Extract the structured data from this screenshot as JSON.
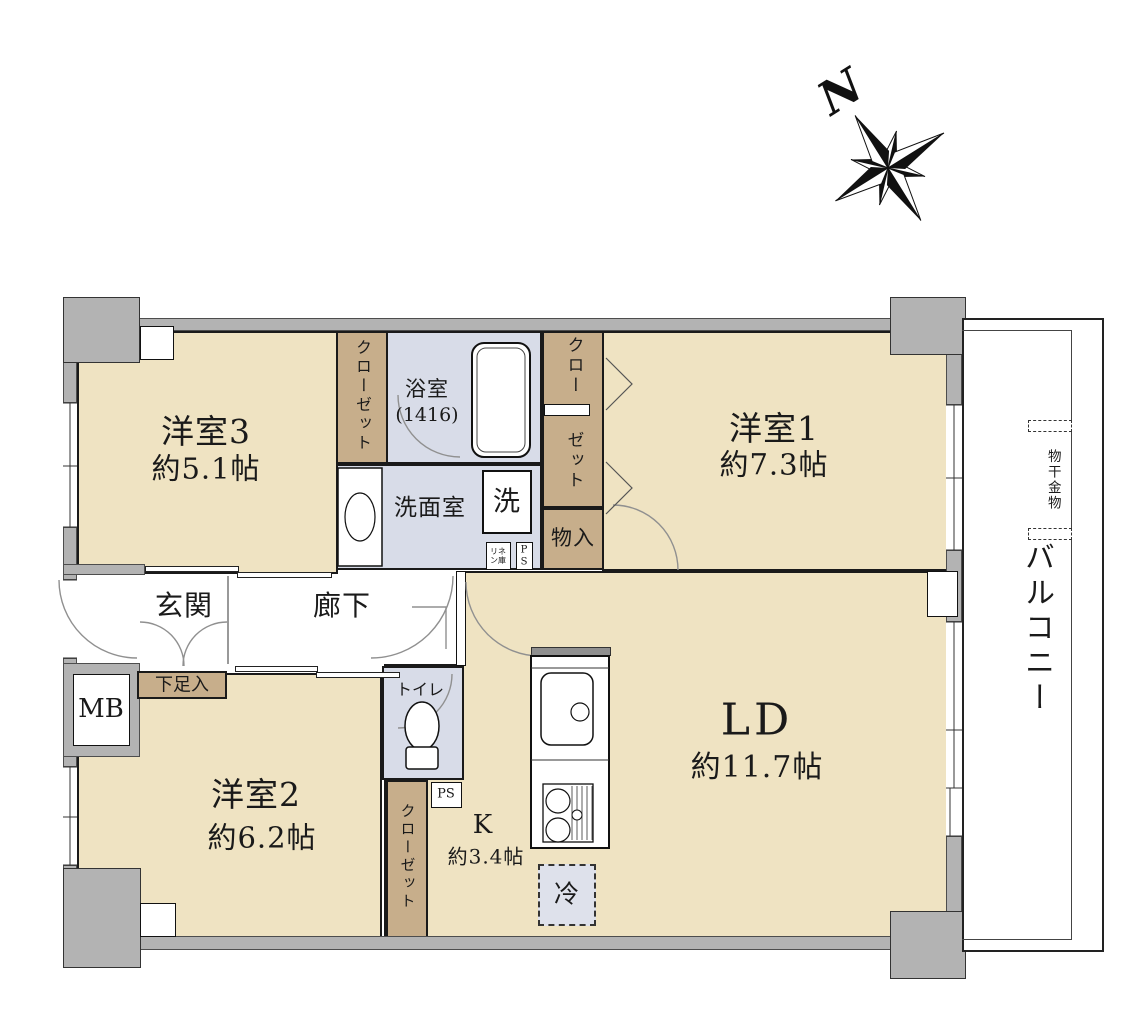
{
  "colors": {
    "room_floor": "#EFE3C2",
    "closet_tan": "#C7AE8B",
    "wet_area_blue": "#D8DCE8",
    "wall_gray": "#B3B3B3",
    "fridge_fill": "#DEE1EB",
    "outline": "#1a1a1a"
  },
  "compass": {
    "north_label": "N"
  },
  "rooms": {
    "western3": {
      "name": "洋室3",
      "size": "約5.1帖"
    },
    "western1": {
      "name": "洋室1",
      "size": "約7.3帖"
    },
    "western2": {
      "name": "洋室2",
      "size": "約6.2帖"
    },
    "living_dining": {
      "name": "LD",
      "size": "約11.7帖"
    },
    "kitchen": {
      "name": "K",
      "size": "約3.4帖"
    },
    "bathroom": {
      "name": "浴室",
      "size": "(1416)"
    },
    "washroom": {
      "name": "洗面室"
    },
    "toilet": {
      "name": "トイレ"
    },
    "entrance": {
      "name": "玄関"
    },
    "hallway": {
      "name": "廊下"
    },
    "balcony": {
      "name": "バルコニー"
    }
  },
  "storage": {
    "closet_west3": {
      "label": "クローゼット"
    },
    "closet_west1_top": "クロー",
    "closet_west1_bottom": "ゼット",
    "closet_west2": {
      "label": "クローゼット"
    },
    "storage_shelf": {
      "label": "物入"
    },
    "shoe_box": {
      "label": "下足入"
    },
    "linen": {
      "label": "リネ\nン庫"
    }
  },
  "fixtures": {
    "washer": {
      "label": "洗"
    },
    "fridge": {
      "label": "冷"
    },
    "meter_box": {
      "label": "MB"
    },
    "pipe_space_upper": {
      "label": "P\nS"
    },
    "pipe_space_lower": {
      "label": "PS"
    },
    "laundry_hardware": {
      "label": "物干金物"
    }
  }
}
